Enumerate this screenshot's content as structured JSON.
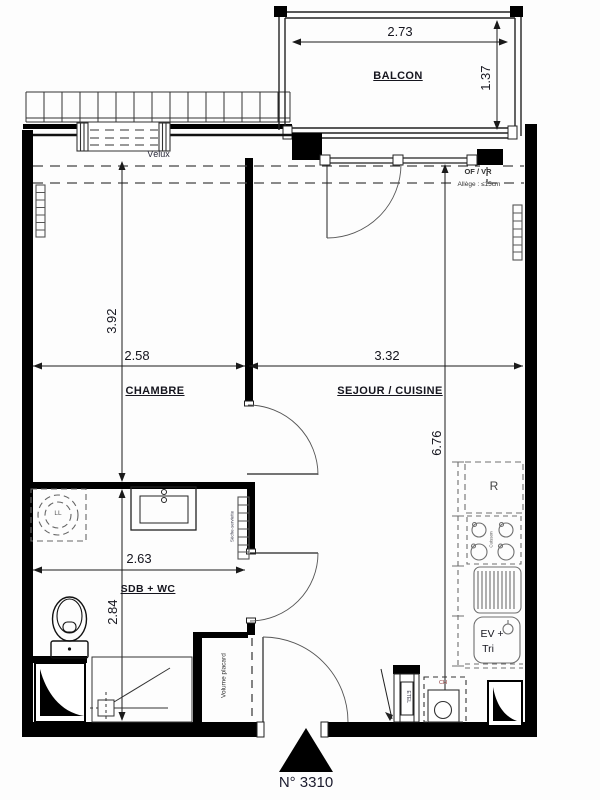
{
  "plan_number": "N° 3310",
  "balcony": {
    "label": "BALCON",
    "width_m": "2.73",
    "depth_m": "1.37"
  },
  "bedroom": {
    "label": "CHAMBRE",
    "length_m": "3.92",
    "width_m": "2.58"
  },
  "living_kitchen": {
    "label": "SEJOUR / CUISINE",
    "width_m": "3.32",
    "length_m": "6.76"
  },
  "bathroom": {
    "label": "SDB + WC",
    "width_m": "2.63",
    "depth_m": "2.84"
  },
  "annotations": {
    "velux": "Vélux",
    "window_type": "OF / VR",
    "sill": "Allège : ≤15cm",
    "washing_machine": "LL",
    "towel_dryer": "Sèche-serviette",
    "closet": "Volume placard",
    "fridge": "R",
    "hob": "Cuisson",
    "sink_line1": "EV +",
    "sink_line2": "Tri",
    "water_heater": "CH",
    "electrical_panel": "ETEL"
  },
  "colors": {
    "wall": "#000000",
    "line": "#222222",
    "dash": "#444444",
    "kitchen": "#6f6f6f"
  }
}
